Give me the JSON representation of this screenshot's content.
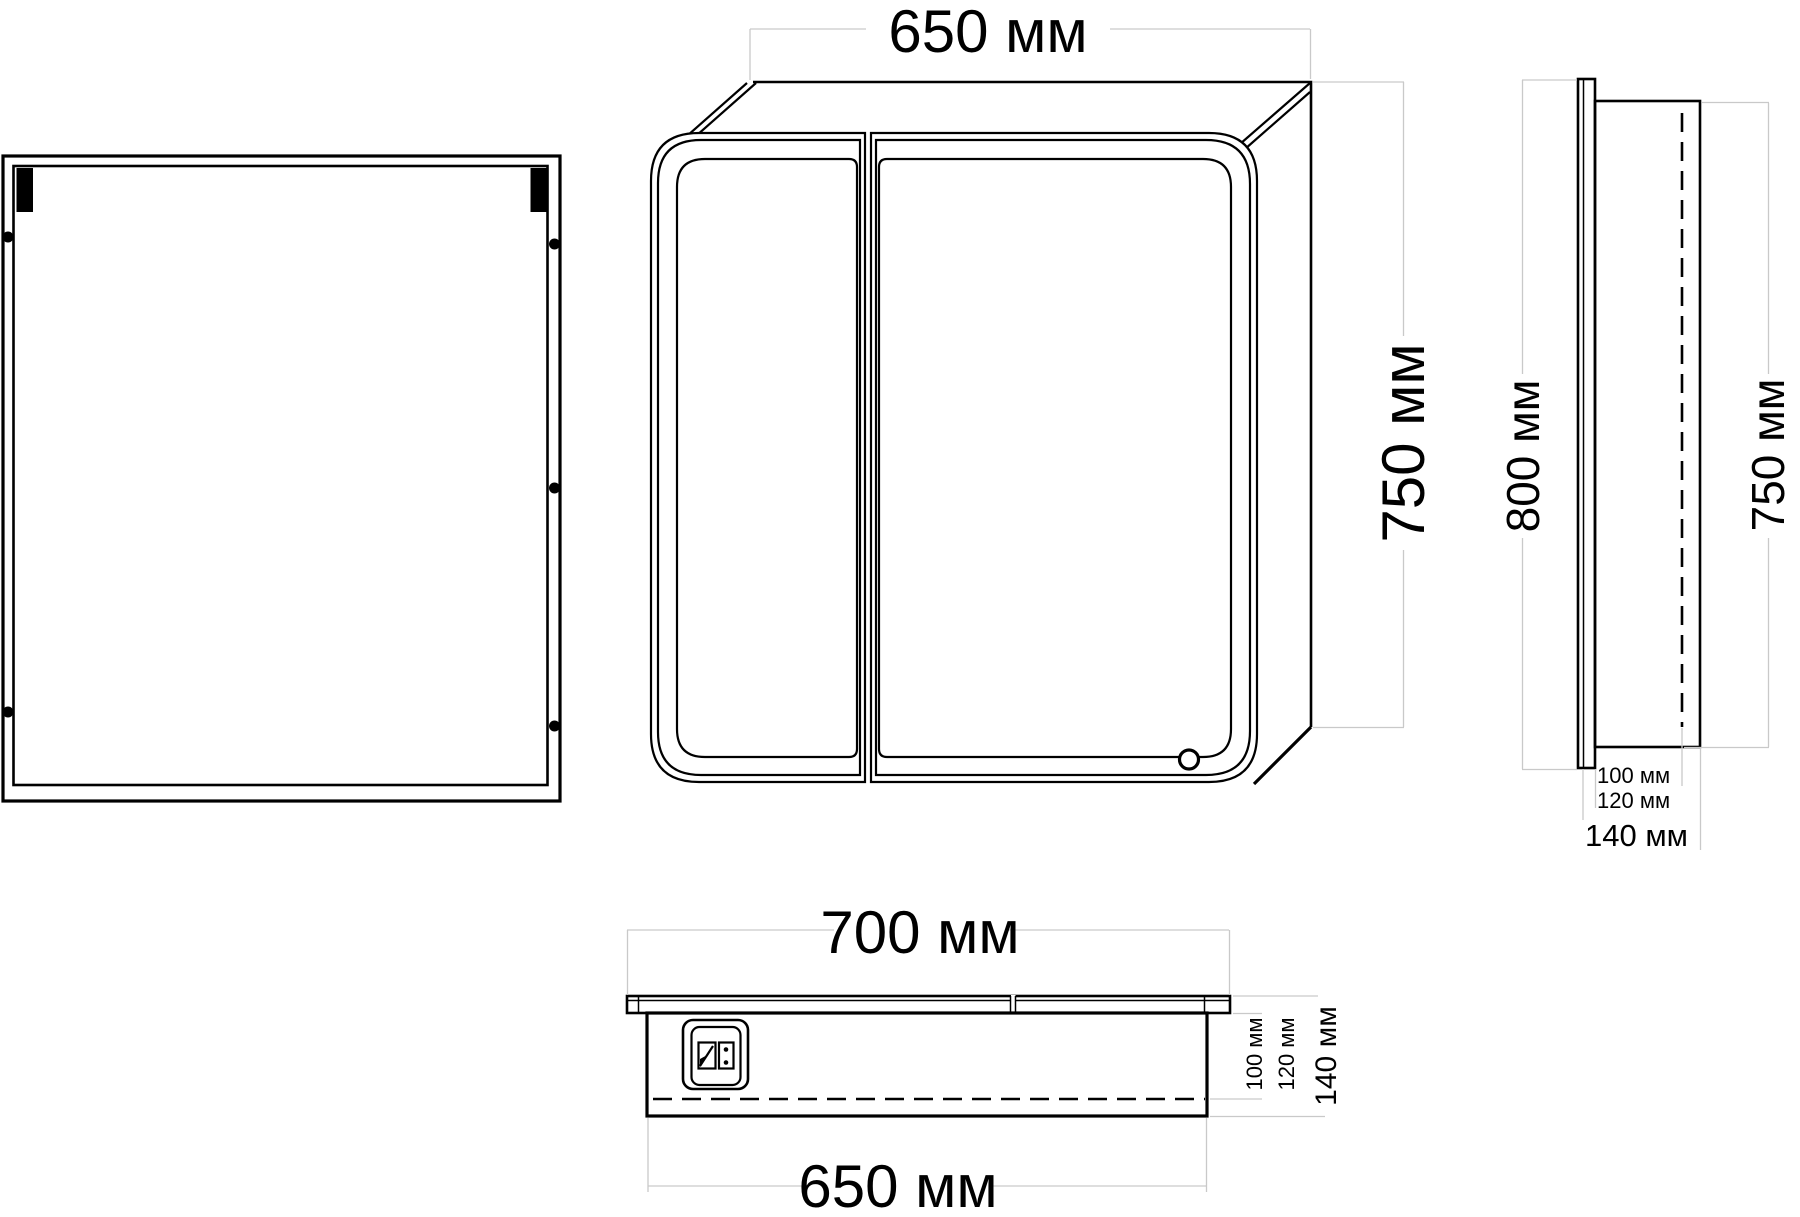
{
  "drawing": {
    "units": "мм",
    "colors": {
      "line": "#000000",
      "dimension_line": "#c9c9c9",
      "background": "#ffffff"
    },
    "front_view": {
      "width_label": "650 мм",
      "height_label": "750 мм"
    },
    "side_view": {
      "overall_height_label": "800 мм",
      "box_height_label": "750 мм",
      "depth_inner_label": "100 мм",
      "depth_mid_label": "120 мм",
      "depth_total_label": "140 мм"
    },
    "bottom_view": {
      "facade_width_label": "700 мм",
      "box_width_label": "650 мм",
      "depth_inner_label": "100 мм",
      "depth_mid_label": "120 мм",
      "depth_total_label": "140 мм"
    }
  }
}
